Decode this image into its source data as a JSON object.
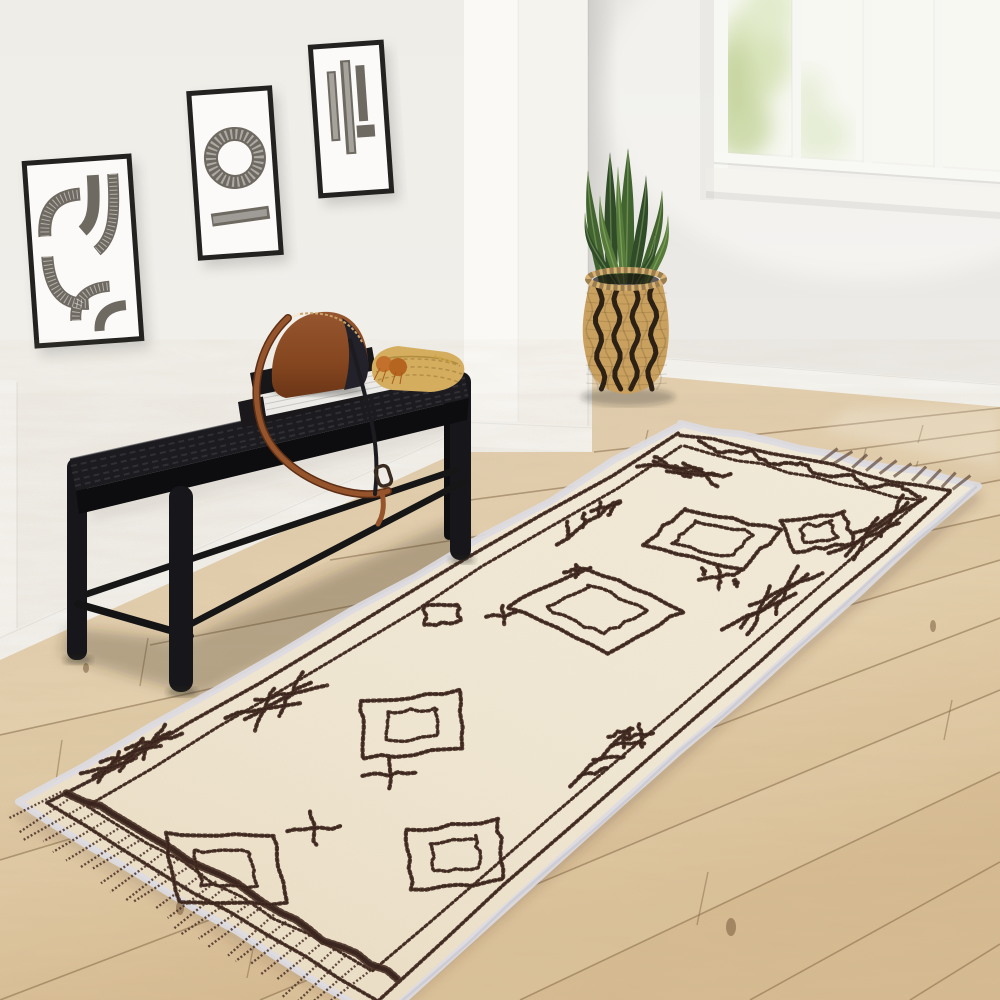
{
  "scene": {
    "description": "Bright entryway photo: three framed abstract prints on a white wall, black woven bench with leather crossbody bag, straw clutch and books, white column, chevron basket with snake plant, bright window, and a cream Moroccan runner rug with dark brown geometric motifs on light oak plank flooring",
    "objects": [
      "framed-artwork-left",
      "framed-artwork-middle",
      "framed-artwork-right",
      "woven-bench",
      "crossbody-bag",
      "straw-clutch",
      "book-stack",
      "column",
      "chevron-basket",
      "snake-plant",
      "window",
      "moroccan-runner-rug",
      "oak-floor"
    ]
  },
  "palette": {
    "wall_left": "#f1efea",
    "wall_back": "#e9e7e3",
    "wall_bright": "#f6f5f1",
    "baseboard": "#f5f4f0",
    "column_face": "#f5f3ee",
    "column_hi": "#faf9f6",
    "floor_light": "#e8d5b2",
    "floor_mid": "#ddc49e",
    "floor_dark": "#d2b68c",
    "seam": "rgba(124,95,62,0.5)",
    "rug_base": "#f0e7d3",
    "rug_light": "#f5eedd",
    "rug_shade": "#e7dac0",
    "rug_motif": "#4a3126",
    "rug_motif_dark": "#33201a",
    "rug_binding": "#dcdbe2",
    "frame_black": "#232220",
    "mat_white": "#fbfaf8",
    "art_gray": "#6e6961",
    "bench_black": "#17161a",
    "bench_weave": "#35343b",
    "leather": "#8d4e2b",
    "leather_dark": "#5d2f16",
    "strap": "#95542b",
    "straw": "#d4ad5f",
    "tassel": "#c2702b",
    "basket_tan": "#c9a05e",
    "basket_dark": "#2c2114",
    "leaf_dark": "#2f4b28",
    "leaf_mid": "#41632f",
    "leaf_light": "#557a3a",
    "pane": "#f7f8f2",
    "green_blur_1": "#d9e4bb",
    "green_blur_2": "#cfdcad"
  },
  "rug": {
    "quad": {
      "T": [
        682,
        423
      ],
      "R": [
        978,
        485
      ],
      "B": [
        382,
        1019
      ],
      "L": [
        17,
        803
      ]
    },
    "borders": [
      {
        "iu": 0.045,
        "iv": 0.02,
        "w": 3.8
      },
      {
        "iu": 0.105,
        "iv": 0.046,
        "w": 3.2
      }
    ],
    "end_band": {
      "v": 0.945,
      "u0": 0.04,
      "u1": 0.96,
      "w": 8
    },
    "fringe": {
      "u0": 0.03,
      "u1": 0.92,
      "step": 0.033,
      "v0": 0.952,
      "v1": 1.035
    },
    "tufts": {
      "u0": 0.5,
      "u1": 0.98,
      "step": 0.05,
      "v0": -0.012,
      "v1": 0.015
    },
    "motifs": [
      {
        "type": "zigzag",
        "u": 0.5,
        "v": 0.033,
        "du": 0.76,
        "dv": 0.014,
        "n": 9
      },
      {
        "type": "xchain",
        "u": 0.2,
        "v": 0.085,
        "du": 0.2,
        "dv": 0.024,
        "n": 2
      },
      {
        "type": "twig",
        "u": 0.17,
        "v": 0.22,
        "du": 0.11,
        "dv": 0.1,
        "dir": 1
      },
      {
        "type": "diamond",
        "u": 0.73,
        "v": 0.13,
        "du": 0.24,
        "dv": 0.08,
        "double": true
      },
      {
        "type": "rect",
        "u": 0.5,
        "v": 0.185,
        "du": 0.3,
        "dv": 0.08,
        "double": true,
        "rot": -6
      },
      {
        "type": "xchain_v",
        "u": 0.865,
        "v": 0.1,
        "du": 0.08,
        "dv": 0.085,
        "n": 2
      },
      {
        "type": "xdash",
        "u": 0.63,
        "v": 0.24,
        "du": 0.07,
        "dv": 0.035
      },
      {
        "type": "xchain_v",
        "u": 0.82,
        "v": 0.25,
        "du": 0.08,
        "dv": 0.09,
        "n": 2
      },
      {
        "type": "rect",
        "u": 0.46,
        "v": 0.35,
        "du": 0.34,
        "dv": 0.1,
        "double": true,
        "rot": 7
      },
      {
        "type": "diamond",
        "u": 0.17,
        "v": 0.445,
        "du": 0.11,
        "dv": 0.05,
        "double": false
      },
      {
        "type": "x",
        "u": 0.29,
        "v": 0.41,
        "du": 0.05,
        "dv": 0.024
      },
      {
        "type": "x",
        "u": 0.3,
        "v": 0.3,
        "du": 0.04,
        "dv": 0.02
      },
      {
        "type": "diamond",
        "u": 0.42,
        "v": 0.62,
        "du": 0.3,
        "dv": 0.15,
        "double": true
      },
      {
        "type": "twig",
        "u": 0.85,
        "v": 0.55,
        "du": 0.11,
        "dv": 0.11,
        "dir": -1
      },
      {
        "type": "x",
        "u": 0.88,
        "v": 0.5,
        "du": 0.05,
        "dv": 0.025
      },
      {
        "type": "x",
        "u": 0.5,
        "v": 0.7,
        "du": 0.08,
        "dv": 0.04
      },
      {
        "type": "x",
        "u": 0.5,
        "v": 0.82,
        "du": 0.08,
        "dv": 0.04
      },
      {
        "type": "xchain_v",
        "u": 0.13,
        "v": 0.675,
        "du": 0.08,
        "dv": 0.08,
        "n": 2
      },
      {
        "type": "diamond",
        "u": 0.8,
        "v": 0.76,
        "du": 0.28,
        "dv": 0.14,
        "double": true
      },
      {
        "type": "diamond",
        "u": 0.45,
        "v": 0.93,
        "du": 0.34,
        "dv": 0.15,
        "double": true
      },
      {
        "type": "xchain_v",
        "u": 0.04,
        "v": 0.85,
        "du": 0.05,
        "dv": 0.1,
        "n": 3
      }
    ]
  },
  "floor": {
    "seams": [
      [
        594,
        452,
        1000,
        408
      ],
      [
        470,
        500,
        1000,
        430
      ],
      [
        330,
        560,
        1000,
        452
      ],
      [
        150,
        645,
        1000,
        480
      ],
      [
        0,
        735,
        1000,
        515
      ],
      [
        0,
        860,
        1000,
        560
      ],
      [
        0,
        1000,
        1000,
        618
      ],
      [
        260,
        1000,
        1000,
        690
      ],
      [
        520,
        1000,
        1000,
        772
      ],
      [
        750,
        1000,
        1000,
        862
      ],
      [
        910,
        1000,
        1000,
        944
      ]
    ],
    "joints": [
      [
        648,
        430,
        643,
        452
      ],
      [
        866,
        448,
        861,
        468
      ],
      [
        918,
        461,
        911,
        484
      ],
      [
        923,
        425,
        918,
        443
      ],
      [
        148,
        638,
        140,
        686
      ],
      [
        62,
        740,
        55,
        788
      ],
      [
        258,
        925,
        247,
        978
      ],
      [
        708,
        872,
        697,
        925
      ],
      [
        952,
        700,
        944,
        740
      ]
    ],
    "knots": [
      [
        731,
        927,
        5,
        9
      ],
      [
        180,
        908,
        4,
        7
      ],
      [
        86,
        668,
        3,
        5
      ],
      [
        933,
        626,
        3,
        6
      ]
    ],
    "bands": [
      {
        "pts": "0,735 1000,515 1000,560 0,860",
        "fill": "rgba(170,130,85,0.07)"
      },
      {
        "pts": "260,1000 1000,690 1000,772 520,1000",
        "fill": "rgba(255,242,214,0.10)"
      },
      {
        "pts": "330,560 1000,452 1000,480 150,645",
        "fill": "rgba(160,120,80,0.05)"
      }
    ]
  },
  "plant": {
    "leaves": [
      {
        "x0": 604,
        "tx": 588,
        "ty": 170,
        "w": 9,
        "c": "leaf_mid"
      },
      {
        "x0": 612,
        "tx": 610,
        "ty": 152,
        "w": 10,
        "c": "leaf_dark"
      },
      {
        "x0": 620,
        "tx": 600,
        "ty": 195,
        "w": 7,
        "c": "leaf_light"
      },
      {
        "x0": 626,
        "tx": 628,
        "ty": 148,
        "w": 11,
        "c": "leaf_mid"
      },
      {
        "x0": 632,
        "tx": 646,
        "ty": 175,
        "w": 9,
        "c": "leaf_dark"
      },
      {
        "x0": 640,
        "tx": 662,
        "ty": 190,
        "w": 8,
        "c": "leaf_mid"
      },
      {
        "x0": 646,
        "tx": 668,
        "ty": 215,
        "w": 7,
        "c": "leaf_light"
      },
      {
        "x0": 616,
        "tx": 585,
        "ty": 212,
        "w": 6,
        "c": "leaf_dark"
      },
      {
        "x0": 636,
        "tx": 655,
        "ty": 232,
        "w": 6,
        "c": "leaf_dark"
      },
      {
        "x0": 624,
        "tx": 618,
        "ty": 166,
        "w": 6,
        "c": "leaf_light"
      }
    ],
    "basket": {
      "cx": 626,
      "rim_y": 279,
      "rx": 38,
      "bottom_y": 394,
      "stripes": 9
    }
  }
}
